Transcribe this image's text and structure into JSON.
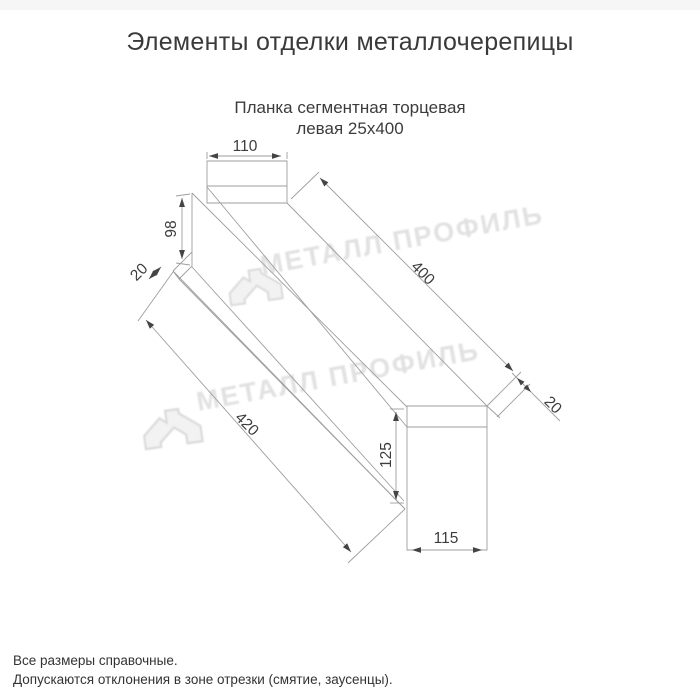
{
  "page": {
    "title": "Элементы отделки металлочерепицы",
    "notes": [
      "Все размеры справочные.",
      "Допускаются отклонения в зоне отрезки (смятие, заусенцы)."
    ]
  },
  "drawing": {
    "subtitle_line1": "Планка сегментная торцевая",
    "subtitle_line2": "левая 25х400",
    "dimensions": {
      "top_width": "110",
      "far_end_height": "98",
      "far_end_hem": "20",
      "top_edge_length": "400",
      "near_end_hem": "20",
      "bottom_edge_length": "420",
      "near_end_height": "125",
      "near_end_width": "115"
    }
  },
  "watermark": {
    "brand": "МЕТАЛЛ ПРОФИЛЬ"
  },
  "colors": {
    "drawing_line": "#9e9e9e",
    "dimension_text": "#3d3d3d",
    "arrow": "#444444",
    "watermark": "#e2e2e2",
    "title_text": "#3a3a3a"
  }
}
